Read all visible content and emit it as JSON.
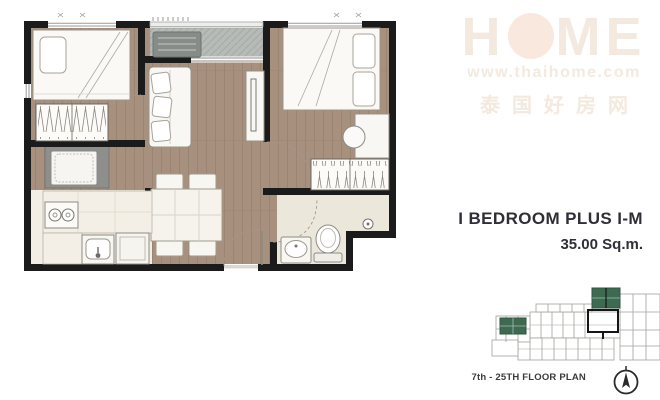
{
  "unit_info": {
    "title": "I BEDROOM PLUS I-M",
    "area": "35.00 Sq.m."
  },
  "mini_plan": {
    "label": "7th - 25TH FLOOR PLAN"
  },
  "watermark": {
    "brand_pre": "H",
    "brand_post": "ME",
    "url": "www.thaihome.com",
    "tagline_cjk": "泰国好房网"
  },
  "colors": {
    "wood_floor": "#a8907e",
    "wood_line": "#97816f",
    "wall": "#1b1b1b",
    "balcony": "#b6bbb8",
    "tile": "#ece7db",
    "kitchen_tile": "#f2eee5",
    "furniture": "#f8f7f3",
    "furniture_stroke": "#98928a",
    "accent_green": "#3d6b52",
    "mini_outline": "#a0a49e",
    "text_dark": "#2f2f37",
    "watermark": "#f3e9df"
  }
}
